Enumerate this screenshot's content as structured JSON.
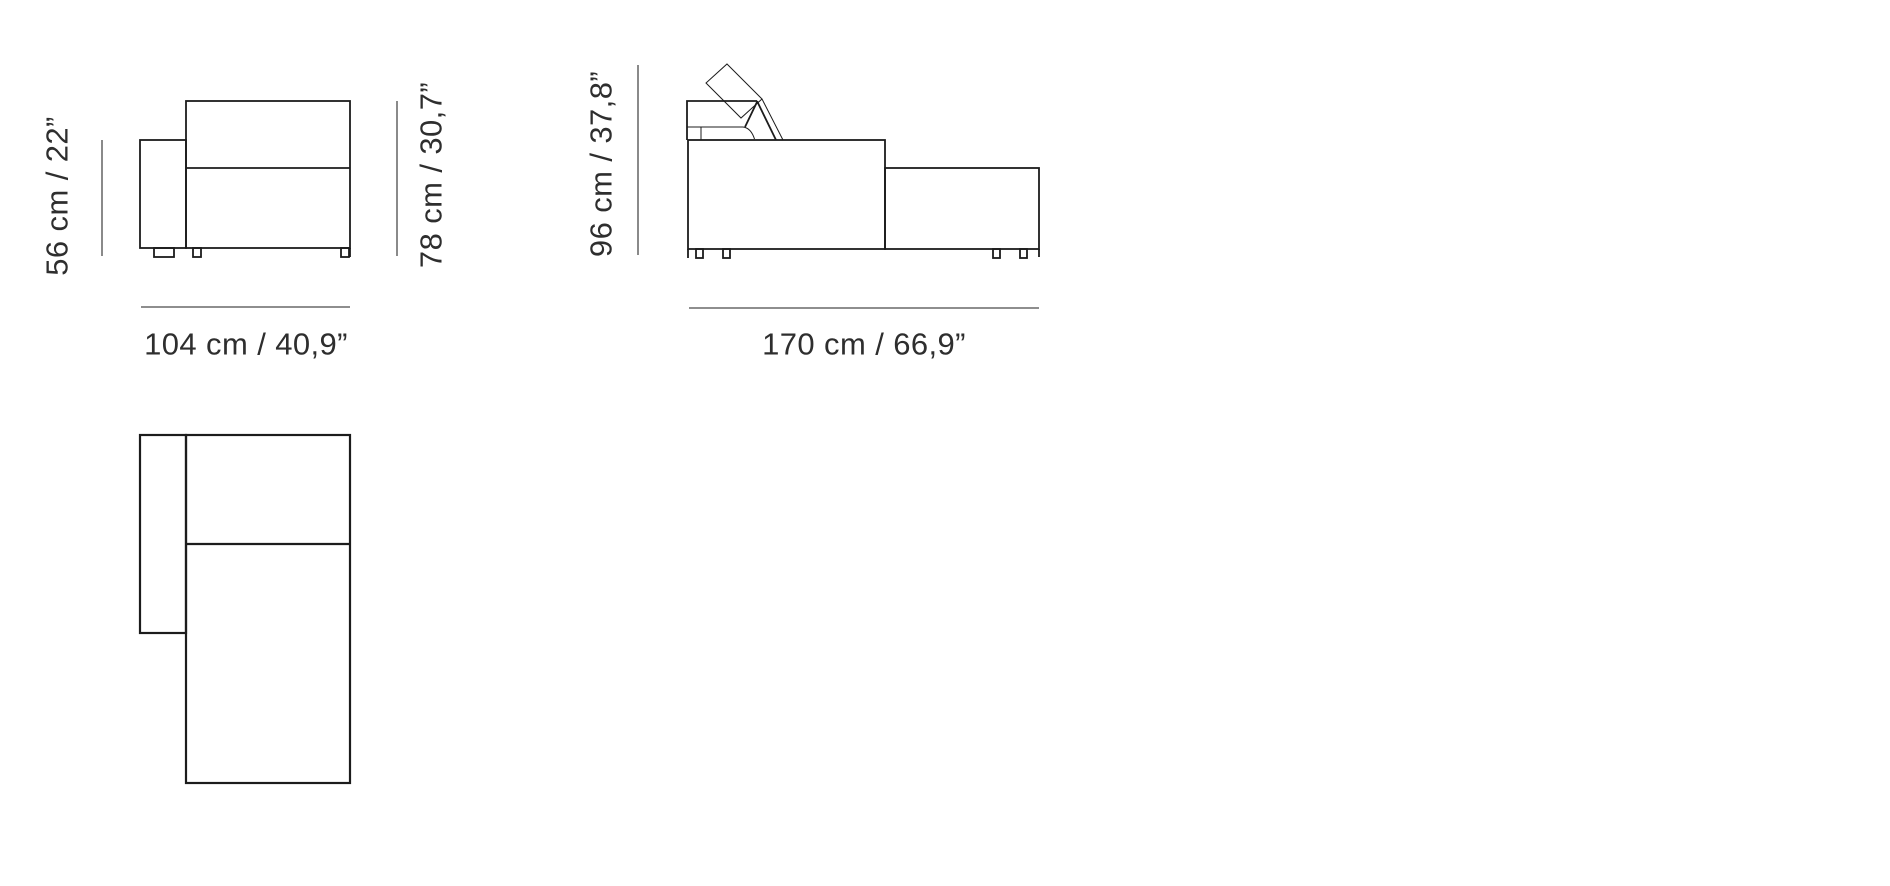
{
  "diagram": {
    "front_view": {
      "arm_height_label": "56 cm / 22”",
      "total_height_label": "78 cm / 30,7”",
      "width_label": "104 cm / 40,9”"
    },
    "side_view": {
      "height_label": "96 cm / 37,8”",
      "depth_label": "170 cm / 66,9”"
    },
    "colors": {
      "background": "#ffffff",
      "line": "#1c1c1c",
      "dimension_line": "#4b4b4b",
      "text": "#2e2e2e"
    }
  }
}
